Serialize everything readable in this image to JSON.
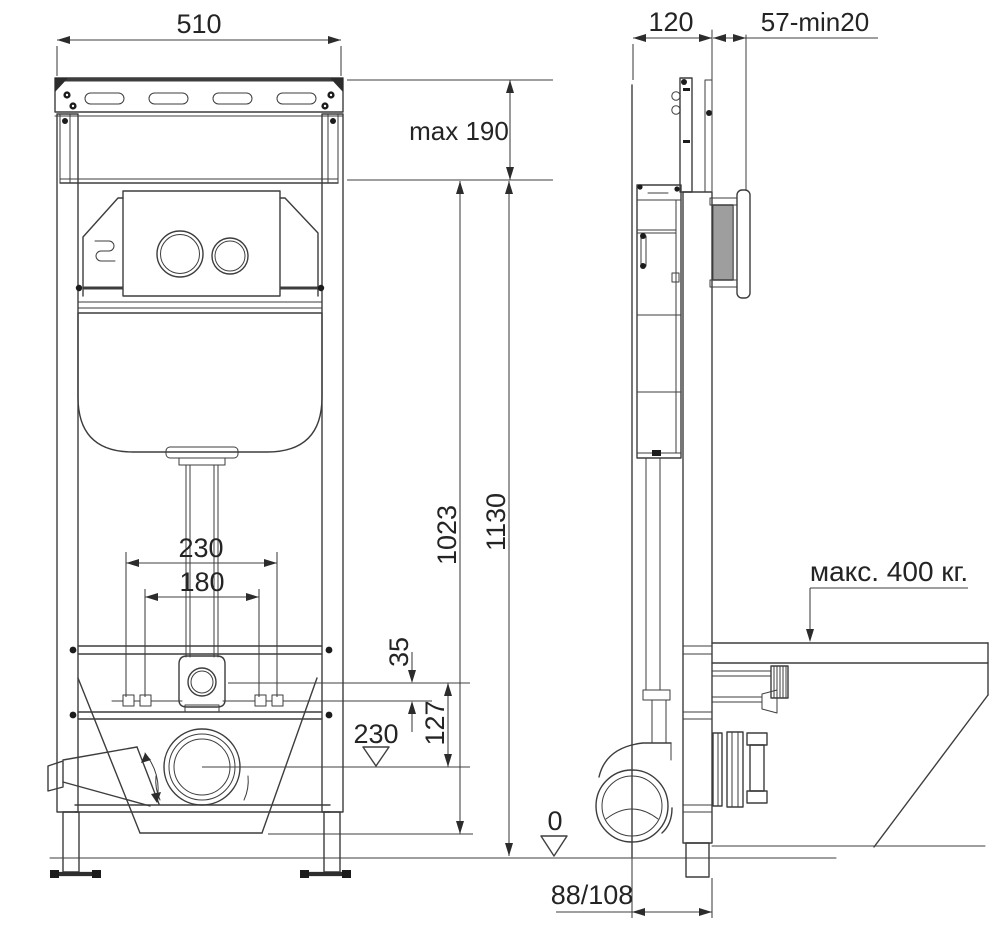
{
  "dimensions": {
    "frame_width_top": "510",
    "frame_depth": "120",
    "front_clearance": "57-min20",
    "top_extension": "max 190",
    "inner_height": "1023",
    "total_height": "1130",
    "fixing_span_outer": "230",
    "fixing_span_inner": "180",
    "flush_to_fixings": "35",
    "flush_to_drain": "127",
    "drain_axis_level": "230",
    "floor_level": "0",
    "drain_axis_offset": "88/108",
    "max_load": "макс. 400 кг."
  },
  "symbols": {
    "level_marker_icon": "open-triangle-datum",
    "load_leader_icon": "down-arrow-leader",
    "rotation_arc_icon": "double-arrow-arc"
  },
  "colors": {
    "line": "#3d3d3d",
    "text": "#242424",
    "background": "#ffffff"
  }
}
